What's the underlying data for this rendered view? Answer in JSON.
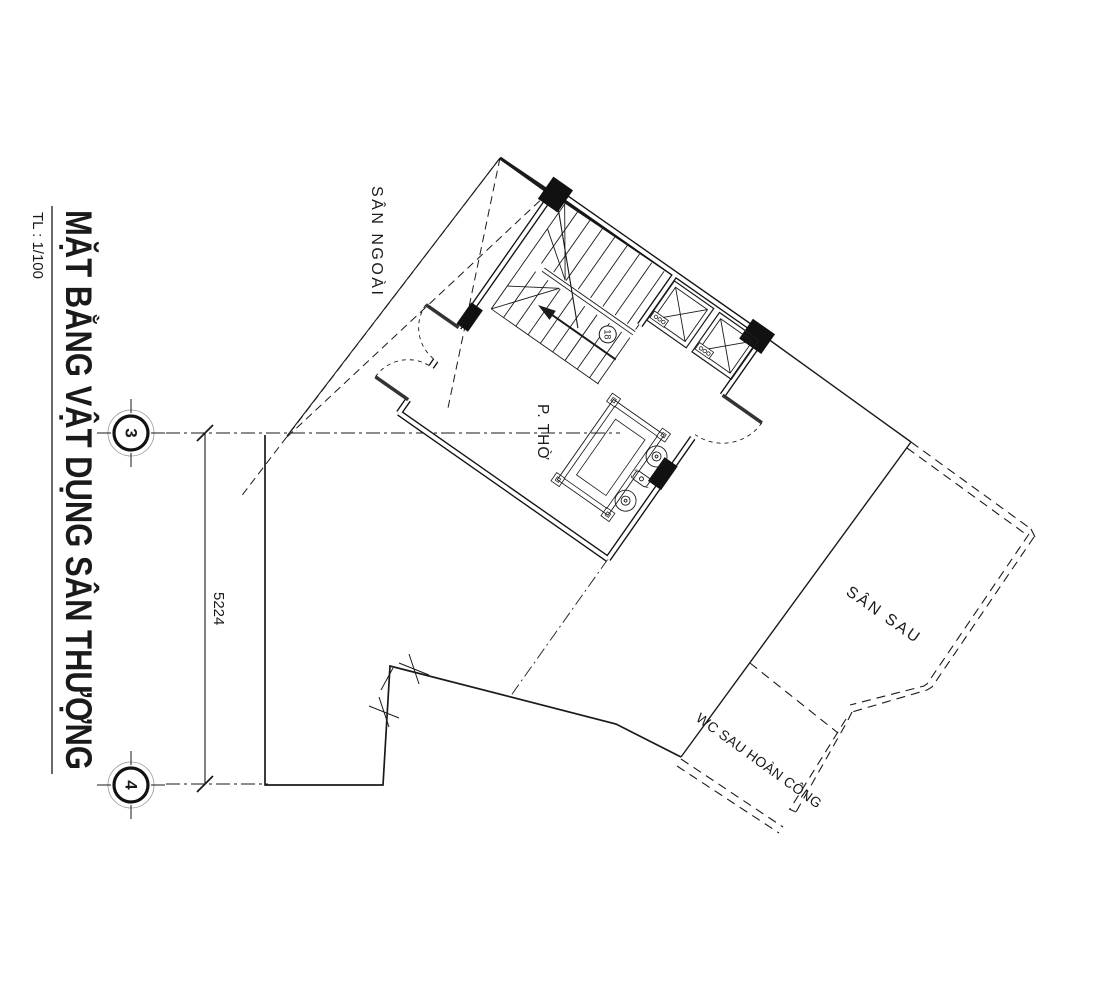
{
  "title_block": {
    "title": "MẶT BẰNG VẬT DỤNG SÂN THƯỢNG",
    "scale": "TL : 1/100"
  },
  "grid": {
    "marker_top": "3",
    "marker_bottom": "4",
    "dimension": "5224"
  },
  "areas": {
    "outer_yard": "SÂN NGOÀI",
    "worship_room": "P. THỜ",
    "back_yard": "SÂN SAU",
    "wc_asbuilt": "WC SAU HOÀN CÔNG"
  },
  "stairs": {
    "step_count": "18"
  },
  "colors": {
    "line": "#1a1a1a",
    "background": "#ffffff"
  }
}
